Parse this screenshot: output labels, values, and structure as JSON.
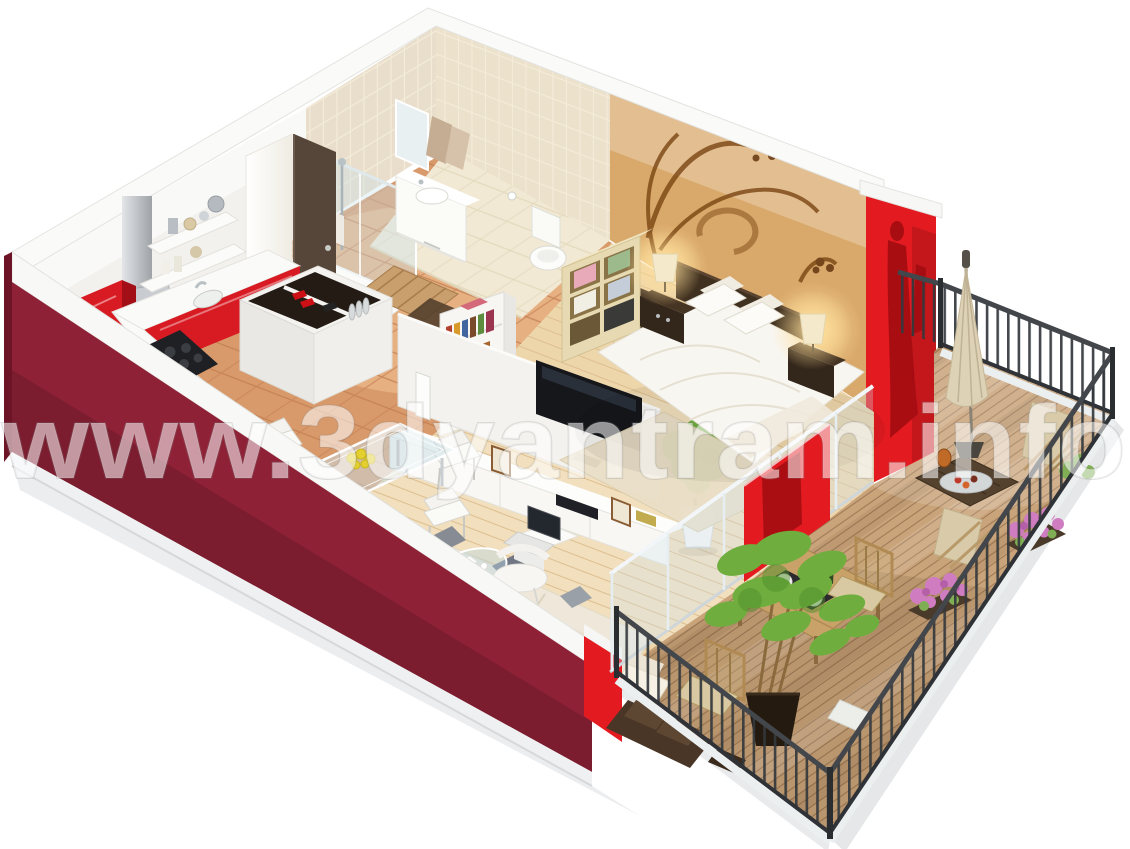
{
  "watermark": {
    "text": "www.3dyantram.info"
  },
  "colors": {
    "background": "#ffffff",
    "wall_white": "#f2f1ed",
    "wall_top_band": "#fafaf8",
    "wall_maroon": "#8e2136",
    "wall_maroon_dark": "#6d1527",
    "wall_red": "#e31b21",
    "red_decal": "#a50d12",
    "wall_tan": "#d9a96b",
    "tile_wall": "#e9decb",
    "floor_bathroom": "#f2e9d4",
    "floor_terracotta": "#d99a6b",
    "floor_wood": "#eed6ab",
    "deck_wood": "#c9a379",
    "railing": "#35393d",
    "kitchen_red": "#d81a22",
    "sofa_cream": "#efe8da",
    "bed_white": "#f8f6f1",
    "headboard_brown": "#40301f",
    "plant_green": "#6fae3e",
    "flower_pink": "#cf7dc0",
    "glass": "#cfe3ea",
    "umbrella_cream": "#ddd1b6",
    "tv_black": "#16171b"
  },
  "scene": {
    "type": "isometric-3d-floor-plan-render",
    "subject": "studio apartment with wrap-around balcony",
    "rooms": [
      {
        "name": "bathroom",
        "items": [
          "glass-shower",
          "vanity-sink",
          "mirror",
          "hanging-towels",
          "toilet",
          "wood-bath-mat"
        ]
      },
      {
        "name": "entry",
        "items": [
          "open-door",
          "door-mat",
          "terracotta-tiles"
        ]
      },
      {
        "name": "kitchen",
        "items": [
          "tall-red-cabinet",
          "built-in-oven",
          "range-hood",
          "red-base-cabinets",
          "black-cooktop",
          "sink",
          "open-shelves",
          "open-storage-chest"
        ]
      },
      {
        "name": "living-dining",
        "items": [
          "white-bookshelf",
          "tv-partition-wall",
          "flat-screen-tv",
          "media-console",
          "framed-pictures",
          "potted-plant",
          "glass-dining-table",
          "white-dining-chairs",
          "cream-sofa",
          "glass-coffee-table",
          "laptop",
          "designer-chair"
        ]
      },
      {
        "name": "bedroom",
        "items": [
          "decal-accent-wall",
          "double-bed",
          "dark-headboard",
          "nightstands",
          "table-lamps",
          "cream-towel-shelf",
          "area-rug"
        ]
      },
      {
        "name": "balcony",
        "items": [
          "wood-deck",
          "black-metal-railing",
          "bamboo-dining-set",
          "bamboo-plant",
          "pink-flower-planters",
          "closed-parasol",
          "sling-chairs",
          "slatted-low-table",
          "outdoor-sofa",
          "glass-sliding-doors",
          "red-sliding-panel"
        ]
      }
    ]
  }
}
